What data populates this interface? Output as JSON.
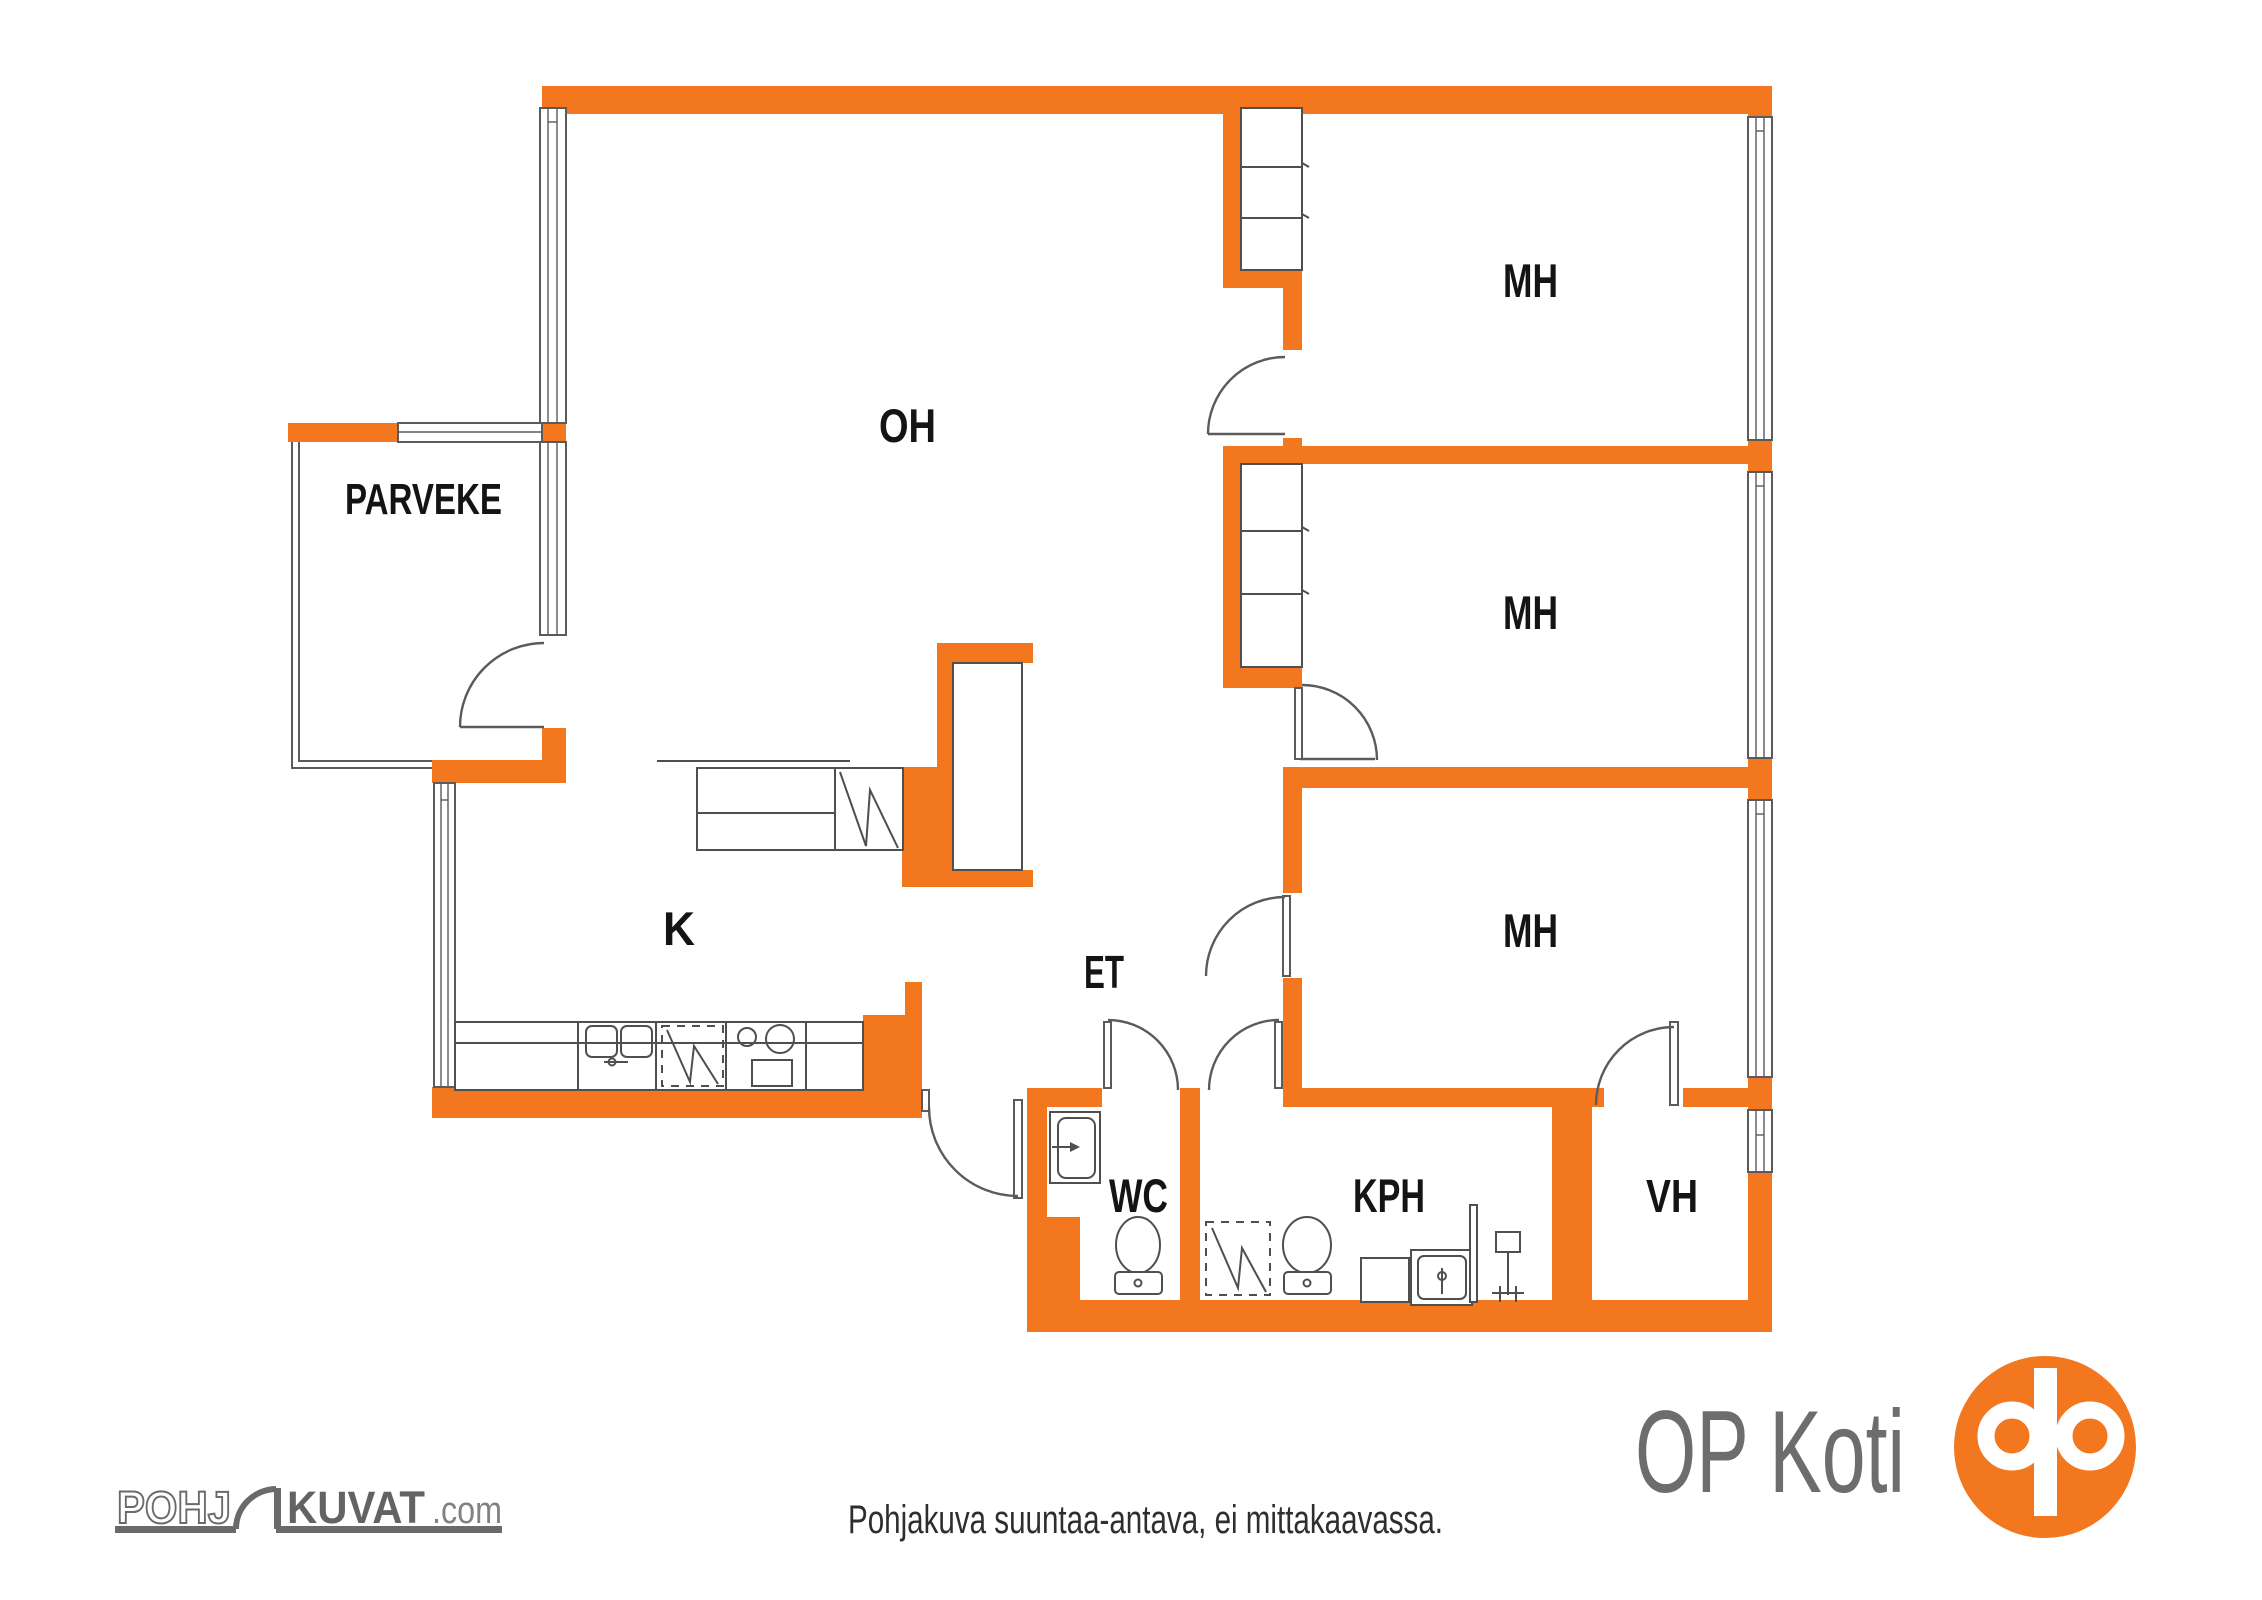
{
  "colors": {
    "wall_orange": "#F2771F",
    "line_gray": "#5b5b5b",
    "label_black": "#141414",
    "brand_gray": "#6d6d6d",
    "logo_orange": "#F2771F"
  },
  "floor_plan": {
    "rooms": [
      {
        "id": "parveke",
        "label": "PARVEKE"
      },
      {
        "id": "oh",
        "label": "OH"
      },
      {
        "id": "mh1",
        "label": "MH"
      },
      {
        "id": "mh2",
        "label": "MH"
      },
      {
        "id": "mh3",
        "label": "MH"
      },
      {
        "id": "k",
        "label": "K"
      },
      {
        "id": "et",
        "label": "ET"
      },
      {
        "id": "wc",
        "label": "WC"
      },
      {
        "id": "kph",
        "label": "KPH"
      },
      {
        "id": "vh",
        "label": "VH"
      }
    ]
  },
  "footer": {
    "pohjakuvat_logo": {
      "outline_text": "POHJ",
      "solid_text": "KUVAT",
      "suffix_text": ".com"
    },
    "disclaimer": "Pohjakuva suuntaa-antava, ei mittakaavassa.",
    "op_koti": {
      "wordmark": "OP Koti"
    }
  }
}
